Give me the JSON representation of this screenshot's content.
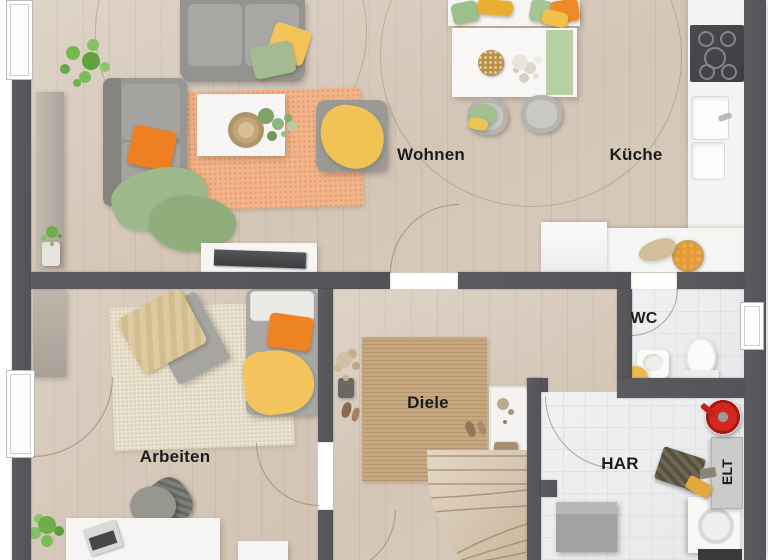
{
  "title": "Erdgeschoss Grundriss",
  "rooms": {
    "wohnen": {
      "label": "Wohnen"
    },
    "kueche": {
      "label": "Küche"
    },
    "arbeiten": {
      "label": "Arbeiten"
    },
    "diele": {
      "label": "Diele"
    },
    "wc": {
      "label": "WC"
    },
    "har": {
      "label": "HAR"
    },
    "elt": {
      "label": "ELT"
    }
  },
  "colors": {
    "wall": "#58585b",
    "wood_floor": "#d7cabc",
    "tile_floor": "#eceeef",
    "rug_orange": "#f2b48a",
    "rug_cream": "#ece4d2",
    "rug_jute": "#c7a77f",
    "accent_orange": "#ef8325",
    "accent_yellow": "#f2c45a",
    "accent_green": "#a4ba90",
    "appliance_dark": "#45464a",
    "alert_red": "#d3281f",
    "label_text": "#1c1c1c"
  }
}
